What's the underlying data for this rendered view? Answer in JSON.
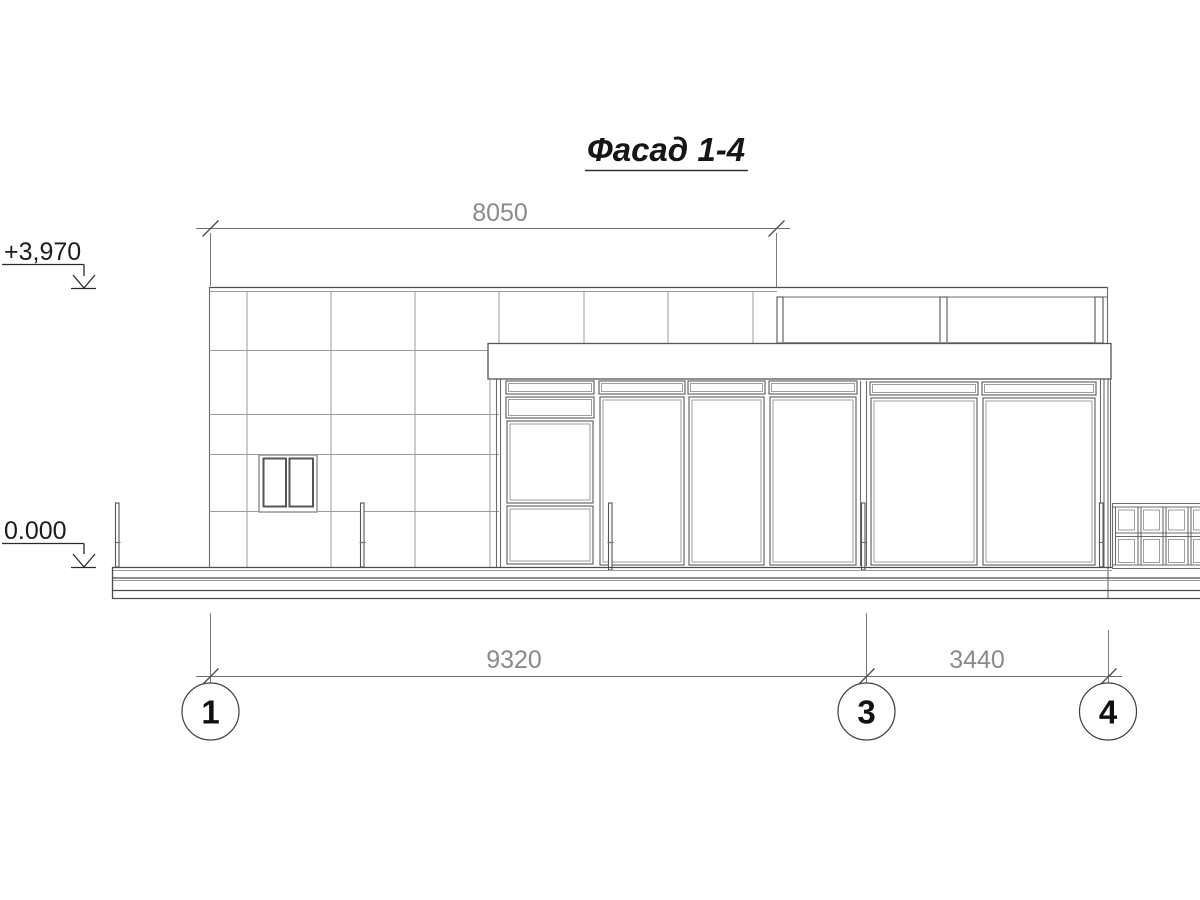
{
  "drawing": {
    "title": "Фасад 1-4",
    "elevation_marks": {
      "roof": "+3,970",
      "ground": "0.000"
    },
    "dimensions": {
      "top_span": "8050",
      "span_1_3": "9320",
      "span_3_4": "3440"
    },
    "axis_markers": [
      {
        "label": "1"
      },
      {
        "label": "3"
      },
      {
        "label": "4"
      }
    ]
  }
}
